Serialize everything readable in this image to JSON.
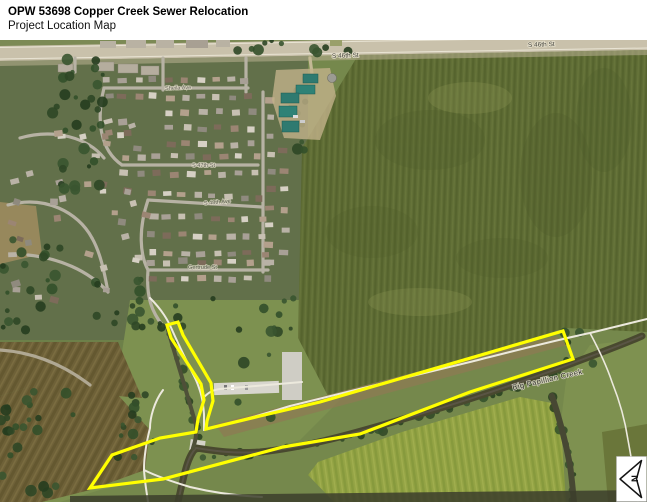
{
  "header": {
    "title": "OPW 53698 Copper Creek Sewer Relocation",
    "subtitle": "Project Location Map"
  },
  "map": {
    "road_labels": [
      {
        "text": "S 46th St"
      },
      {
        "text": "S 46th St"
      }
    ],
    "street_labels": [
      {
        "text": "Sheila Ave"
      },
      {
        "text": "S 47th St"
      },
      {
        "text": "S 48th Ave"
      },
      {
        "text": "Gertrude St"
      }
    ],
    "creek_label": "Big Papillion Creek",
    "north_arrow_letter": "N",
    "outline_color": "#FFFF00"
  }
}
